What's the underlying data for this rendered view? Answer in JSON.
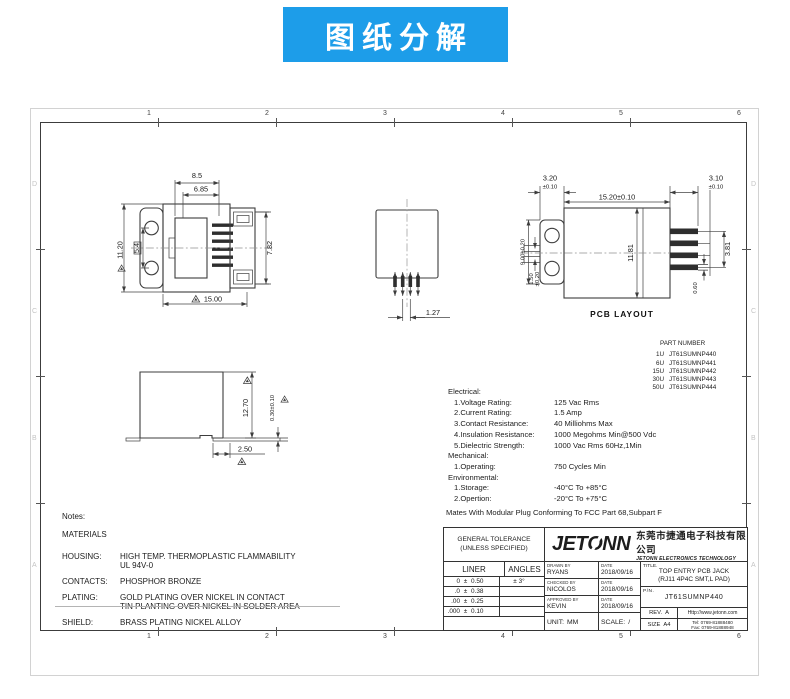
{
  "banner": {
    "text": "图纸分解",
    "bg_color": "#1d9de9"
  },
  "frame": {
    "cols": [
      "1",
      "2",
      "3",
      "4",
      "5",
      "6"
    ],
    "rows": [
      "D",
      "C",
      "B",
      "A"
    ]
  },
  "front_view": {
    "dim_width_outer": "8.5",
    "dim_width_inner": "6.85",
    "dim_height": "11.20",
    "dim_hole_pitch": "5.4",
    "dim_depth": "7.82",
    "dim_body_width": "15.00"
  },
  "top_view": {
    "dim_pin_pitch": "1.27"
  },
  "pcb_layout": {
    "label": "PCB LAYOUT",
    "dim_pad_left": "3.20",
    "dim_pad_left_tol": "±0.10",
    "dim_body": "15.20±0.10",
    "dim_pad_right": "3.10",
    "dim_pad_right_tol": "±0.10",
    "dim_height": "9.00±0.20",
    "dim_slot": "1.50",
    "dim_slot_tol": "±0.20",
    "dim_inner_height": "11.81",
    "dim_pad_span": "3.81",
    "dim_pad_width": "0.60"
  },
  "side_view": {
    "dim_height": "12.70",
    "dim_standoff": "0.30±0.10",
    "dim_tail": "2.50"
  },
  "part_numbers": {
    "title": "PART NUMBER",
    "rows": [
      {
        "code": "1U",
        "pn": "JT61SUMNP440"
      },
      {
        "code": "6U",
        "pn": "JT61SUMNP441"
      },
      {
        "code": "15U",
        "pn": "JT61SUMNP442"
      },
      {
        "code": "30U",
        "pn": "JT61SUMNP443"
      },
      {
        "code": "50U",
        "pn": "JT61SUMNP444"
      }
    ]
  },
  "specs": {
    "rows": [
      {
        "label": "Electrical:",
        "value": ""
      },
      {
        "label": "1.Voltage Rating:",
        "value": "125 Vac Rms"
      },
      {
        "label": "2.Current Rating:",
        "value": "1.5 Amp"
      },
      {
        "label": "3.Contact Resistance:",
        "value": "40 Milliohms Max"
      },
      {
        "label": "4.Insulation Resistance:",
        "value": "1000 Megohms Min@500 Vdc"
      },
      {
        "label": "5.Dielectric Strength:",
        "value": "1000 Vac Rms 60Hz,1Min"
      },
      {
        "label": "Mechanical:",
        "value": ""
      },
      {
        "label": "1.Operating:",
        "value": "750 Cycles Min"
      },
      {
        "label": "Environmental:",
        "value": ""
      },
      {
        "label": "1.Storage:",
        "value": "-40°C To +85°C"
      },
      {
        "label": "2.Opertion:",
        "value": "-20°C To +75°C"
      }
    ],
    "footer": "Mates With Modular Plug Conforming To FCC Part 68,Subpart F"
  },
  "notes": {
    "title": "Notes:",
    "materials": "MATERIALS",
    "rows": [
      {
        "label": "HOUSING:",
        "line1": "HIGH TEMP. THERMOPLASTIC FLAMMABILITY",
        "line2": "UL 94V-0"
      },
      {
        "label": "CONTACTS:",
        "line1": "PHOSPHOR BRONZE",
        "line2": ""
      },
      {
        "label": "PLATING:",
        "line1": "GOLD PLATING OVER NICKEL IN CONTACT",
        "line2": "TIN PLANTING OVER NICKEL IN SOLDER AREA"
      },
      {
        "label": "SHIELD:",
        "line1": "BRASS PLATING NICKEL ALLOY",
        "line2": ""
      }
    ]
  },
  "title_block": {
    "general_tolerance_line1": "GENERAL TOLERANCE",
    "general_tolerance_line2": "(UNLESS SPECIFIED)",
    "liner_header": "LINER",
    "angles_header": "ANGLES",
    "tolerances": [
      {
        "range": "0",
        "pm": "±",
        "value": "0.50",
        "angle": "± 3°"
      },
      {
        "range": ".0",
        "pm": "±",
        "value": "0.38",
        "angle": ""
      },
      {
        "range": ".00",
        "pm": "±",
        "value": "0.25",
        "angle": ""
      },
      {
        "range": ".000",
        "pm": "±",
        "value": "0.10",
        "angle": ""
      }
    ],
    "logo": {
      "part1": "JET",
      "part2": "O",
      "part3": "NN"
    },
    "company_cn": "东莞市捷通电子科技有限公司",
    "company_en": "JETONN ELECTRONICS TECHNOLOGY",
    "drawn_by_label": "DRAWN BY",
    "date_label": "DATE",
    "drawn_by": "RYANS",
    "drawn_date": "2018/09/16",
    "checked_by_label": "CHECKED BY",
    "checked_by": "NICOLOS",
    "checked_date": "2018/09/16",
    "approved_by_label": "APPROVED BY",
    "approved_by": "KEVIN",
    "approved_date": "2018/09/16",
    "unit_label": "UNIT:",
    "unit": "MM",
    "scale_label": "SCALE:",
    "scale": "/",
    "title_label": "TITLE.",
    "title_line1": "TOP ENTRY PCB JACK",
    "title_line2": "(RJ11 4P4C SMT,L PAD)",
    "pn_label": "P/N.",
    "pn": "JT61SUMNP440",
    "rev_label": "REV.",
    "rev": "A",
    "size_label": "SIZE",
    "size": "A4",
    "website": "Http://www.jetonn.com",
    "tel": "Tel: 0769-81888480",
    "fax": "Fax: 0769-81888948"
  }
}
